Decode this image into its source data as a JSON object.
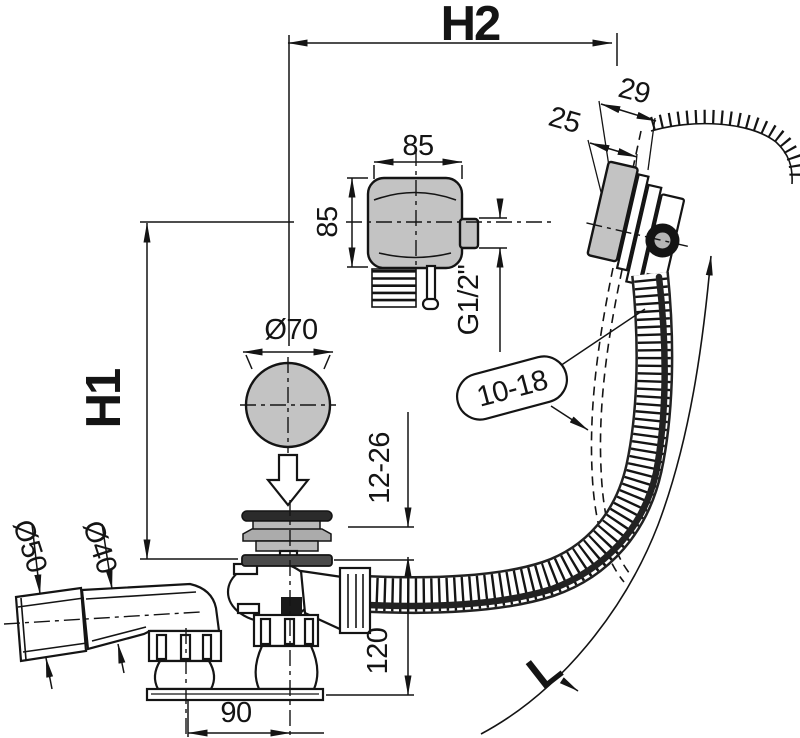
{
  "colors": {
    "line": "#141414",
    "part_fill": "#c3c3c3",
    "knob_fill": "#141414",
    "cable": "#222222",
    "background": "#ffffff"
  },
  "labels": {
    "h2": "H2",
    "h1": "H1",
    "length": "L",
    "box_width": "85",
    "box_height": "85",
    "thread": "G1/2\"",
    "plug_diameter": "Ø70",
    "wall_thickness": "10-18",
    "rim_offset_outer": "29",
    "rim_offset_inner": "25",
    "floor_range": "12-26",
    "sleeve_diameter": "Ø50",
    "pipe_diameter": "Ø40",
    "body_height": "120",
    "outlet_offset": "90"
  }
}
